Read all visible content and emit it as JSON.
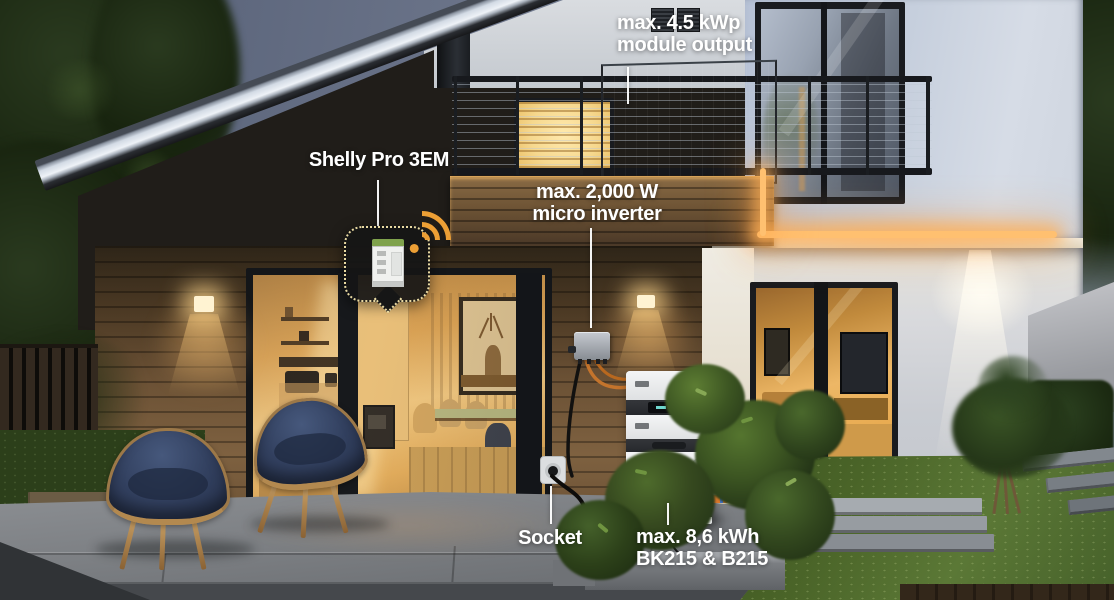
{
  "scene": {
    "description": "Dusk photo of a modern house with balcony solar panels, micro inverter, wall socket and stacked battery storage, annotated with white callout labels"
  },
  "callouts": {
    "module_output": {
      "line1": "max. 4.5 kWp",
      "line2": "module output"
    },
    "shelly": {
      "label": "Shelly Pro 3EM"
    },
    "micro_inverter": {
      "line1": "max. 2,000 W",
      "line2": "micro inverter"
    },
    "socket": {
      "label": "Socket"
    },
    "battery": {
      "line1": "max. 8,6 kWh",
      "line2": "BK215 & B215"
    }
  },
  "icons": {
    "wifi": "wifi-icon",
    "shelly_device": "shelly-pro-3em-device"
  },
  "colors": {
    "callout_text": "#ffffff",
    "wifi_accent": "#ec9f35",
    "badge_border": "#e8d9a2",
    "led_glow": "#ffb765",
    "battery_connector_orange": "#d8772b",
    "battery_connector_blue": "#3f6fc4",
    "warm_window": "#f0b45f",
    "dusk_sky": "#6b7489"
  }
}
